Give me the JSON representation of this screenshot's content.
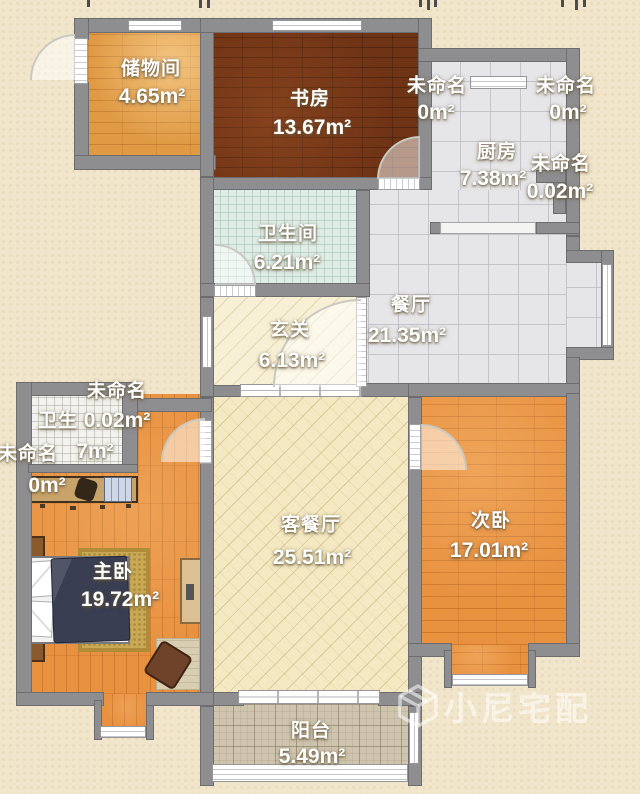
{
  "watermark": {
    "text": "小尼宅配"
  },
  "rooms": [
    {
      "id": "storage",
      "name": "储物间",
      "area": "4.65m²"
    },
    {
      "id": "study",
      "name": "书房",
      "area": "13.67m²"
    },
    {
      "id": "unnamed-1",
      "name": "未命名",
      "area": "0m²"
    },
    {
      "id": "unnamed-2",
      "name": "未命名",
      "area": "0m²"
    },
    {
      "id": "kitchen",
      "name": "厨房",
      "area": "7.38m²"
    },
    {
      "id": "unnamed-3",
      "name": "未命名",
      "area": "0.02m²"
    },
    {
      "id": "bathroom",
      "name": "卫生间",
      "area": "6.21m²"
    },
    {
      "id": "dining",
      "name": "餐厅",
      "area": "21.35m²"
    },
    {
      "id": "entry",
      "name": "玄关",
      "area": "6.13m²"
    },
    {
      "id": "unnamed-4",
      "name": "未命名",
      "area": "0.02m²"
    },
    {
      "id": "bathroom-2",
      "name": "卫生",
      "area": "7m²"
    },
    {
      "id": "unnamed-5",
      "name": "未命名",
      "area": "0m²"
    },
    {
      "id": "master",
      "name": "主卧",
      "area": "19.72m²"
    },
    {
      "id": "living",
      "name": "客餐厅",
      "area": "25.51m²"
    },
    {
      "id": "second",
      "name": "次卧",
      "area": "17.01m²"
    },
    {
      "id": "balcony",
      "name": "阳台",
      "area": "5.49m²"
    }
  ]
}
